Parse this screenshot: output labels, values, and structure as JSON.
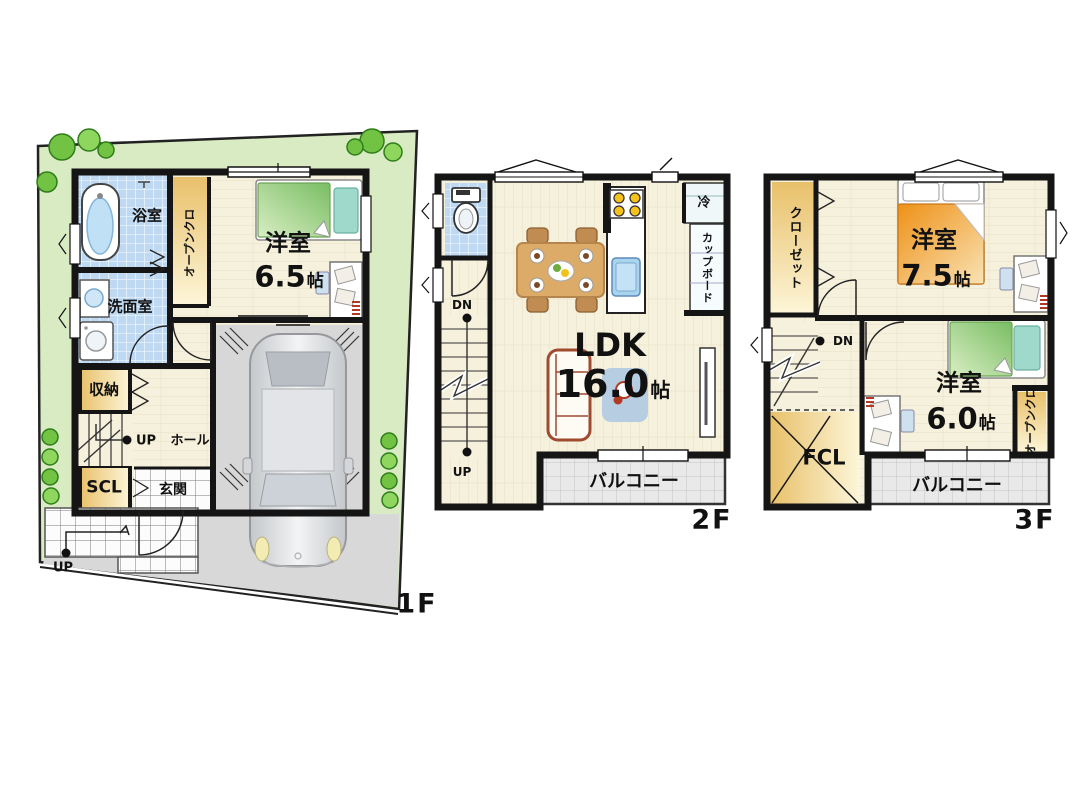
{
  "floor1": {
    "floor_label": "1F",
    "bath": "浴室",
    "washroom": "洗面室",
    "storage": "収納",
    "shoe_closet": "SCL",
    "entrance": "玄関",
    "hall": "ホール",
    "stairs_up": "UP",
    "approach_up": "UP",
    "open_closet": "オープンクロ",
    "bedroom": {
      "name": "洋室",
      "size_num": "6.5",
      "size_unit": "帖"
    }
  },
  "floor2": {
    "floor_label": "2F",
    "stairs_down": "DN",
    "stairs_up": "UP",
    "ldk": {
      "name": "LDK",
      "size_num": "16.0",
      "size_unit": "帖"
    },
    "fridge": "冷",
    "cupboard": "カップボード",
    "balcony": "バルコニー"
  },
  "floor3": {
    "floor_label": "3F",
    "closet": "クローゼット",
    "stairs_down": "DN",
    "fcl": "FCL",
    "open_closet": "オープンクロ",
    "balcony": "バルコニー",
    "bedroom_a": {
      "name": "洋室",
      "size_num": "7.5",
      "size_unit": "帖"
    },
    "bedroom_b": {
      "name": "洋室",
      "size_num": "6.0",
      "size_unit": "帖"
    }
  },
  "colors": {
    "wall": "#151515",
    "garden": "#d9ebc2",
    "driveway": "#d8d8d8",
    "garage": "#d7d7d7",
    "bed_green": "#8cc878",
    "bed_teal": "#9ed9cb",
    "sofa_trim": "#a04a30",
    "table_wood": "#dcab67",
    "tree_fill": "#72c244",
    "tree_edge": "#2f7d1a"
  }
}
